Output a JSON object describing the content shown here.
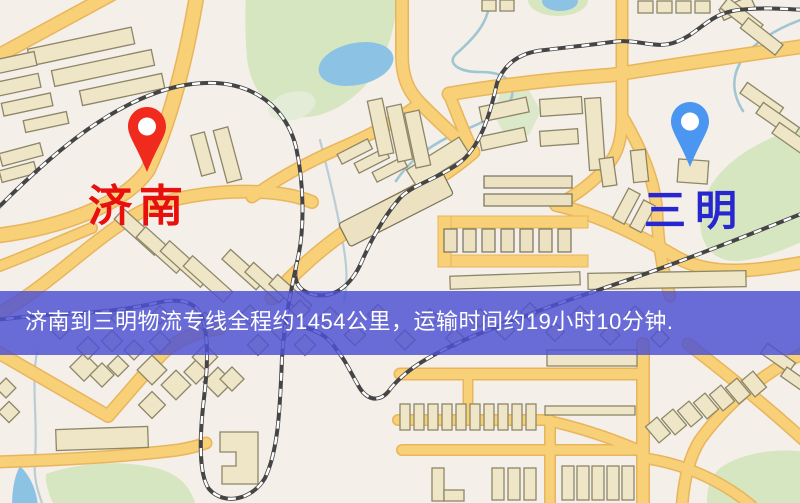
{
  "map": {
    "origin": {
      "name": "济南",
      "pin_color": "#f12a1e",
      "label_color": "#e8100c"
    },
    "destination": {
      "name": "三明",
      "pin_color": "#4a96f0",
      "label_color": "#2726cf"
    },
    "banner": {
      "text": "济南到三明物流专线全程约1454公里，运输时间约19小时10分钟.",
      "bg_color": "rgba(77,81,212,0.83)",
      "text_color": "#ffffff"
    },
    "legend_colors": {
      "land": "#f4efe8",
      "road": "#f7d077",
      "road_casing": "#e9b55c",
      "building": "#efe5c7",
      "building_outline": "#8d8668",
      "water": "#8cc3e4",
      "park": "#d5e6c0",
      "railway": "#454545"
    }
  }
}
